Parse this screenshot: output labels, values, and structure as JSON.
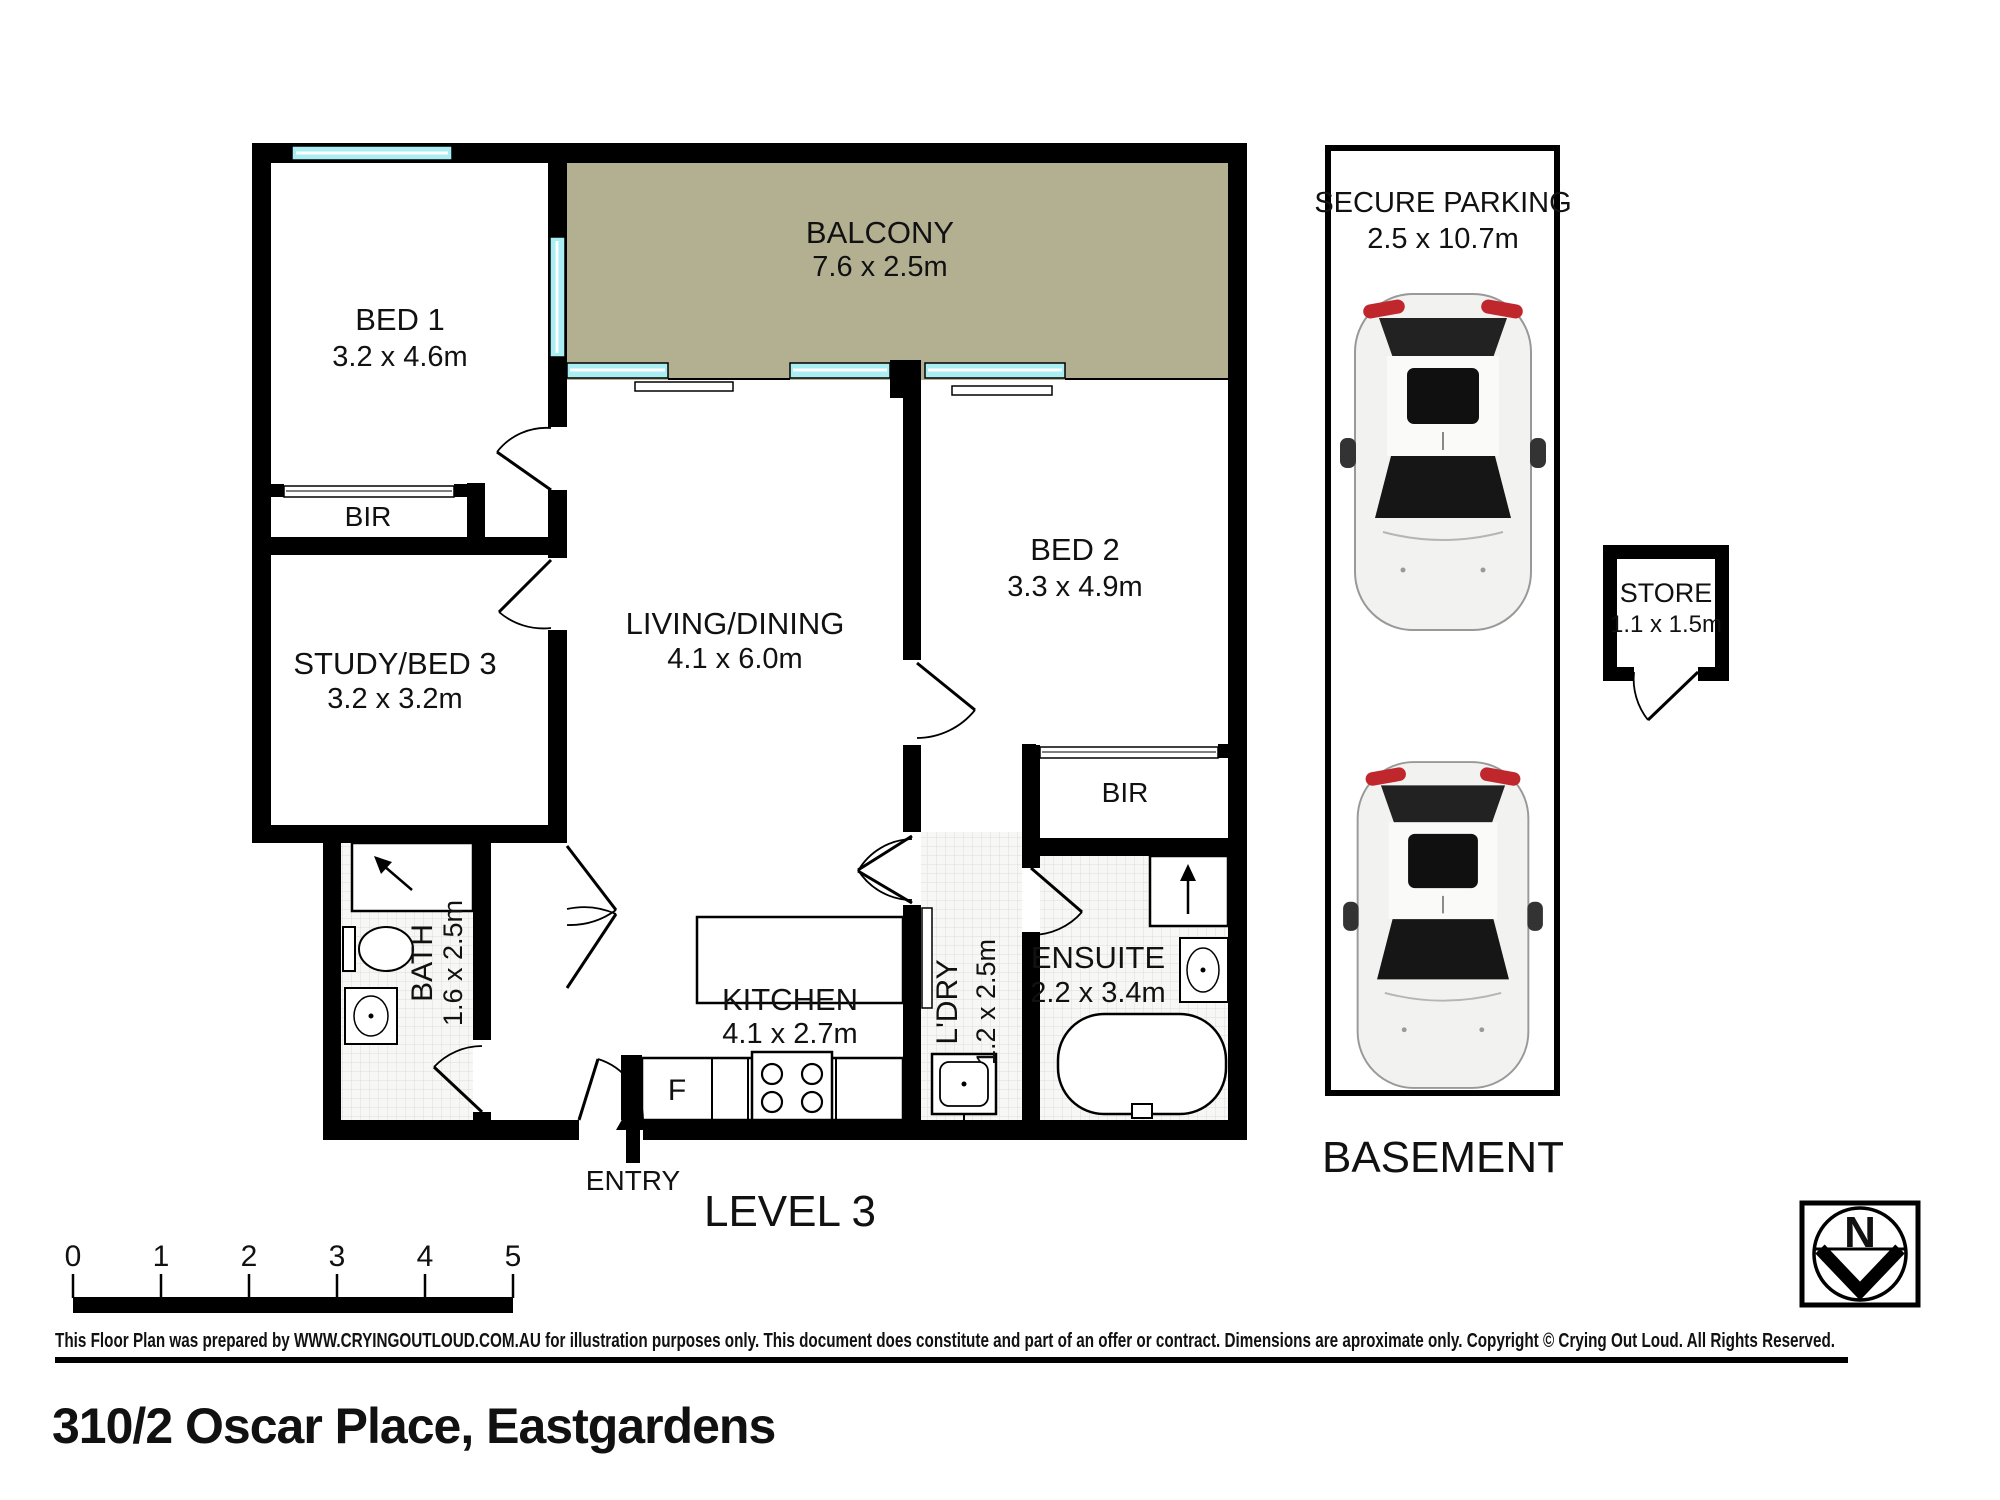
{
  "floor_plan": {
    "level_label": "LEVEL 3",
    "entry_label": "ENTRY",
    "fridge_label": "F",
    "rooms": {
      "bed1": {
        "name": "BED 1",
        "dims": "3.2 x 4.6m"
      },
      "balcony": {
        "name": "BALCONY",
        "dims": "7.6 x 2.5m"
      },
      "bir_left": {
        "name": "BIR"
      },
      "study": {
        "name": "STUDY/BED 3",
        "dims": "3.2 x 3.2m"
      },
      "living": {
        "name": "LIVING/DINING",
        "dims": "4.1 x 6.0m"
      },
      "bed2": {
        "name": "BED 2",
        "dims": "3.3 x 4.9m"
      },
      "bir_right": {
        "name": "BIR"
      },
      "bath": {
        "name": "BATH",
        "dims": "1.6 x 2.5m"
      },
      "kitchen": {
        "name": "KITCHEN",
        "dims": "4.1 x 2.7m"
      },
      "laundry": {
        "name": "L'DRY",
        "dims": "1.2 x 2.5m"
      },
      "ensuite": {
        "name": "ENSUITE",
        "dims": "2.2 x 3.4m"
      }
    }
  },
  "parking": {
    "title": "SECURE PARKING",
    "dims": "2.5 x 10.7m",
    "area_label": "BASEMENT"
  },
  "store": {
    "name": "STORE",
    "dims": "1.1 x 1.5m"
  },
  "compass": {
    "north_label": "N"
  },
  "scale_bar": {
    "labels": [
      "0",
      "1",
      "2",
      "3",
      "4",
      "5"
    ]
  },
  "footer": {
    "disclaimer": "This Floor Plan was prepared by WWW.CRYINGOUTLOUD.COM.AU for illustration purposes only. This document does constitute and part of an offer or contract. Dimensions are aproximate only. Copyright © Crying Out Loud. All Rights Reserved.",
    "address": "310/2 Oscar Place, Eastgardens"
  },
  "colors": {
    "wall": "#000000",
    "window": "#a9eef2",
    "balcony_floor": "#b3b092",
    "tile_line": "#dcdcda",
    "car_accent": "#c0272d"
  }
}
